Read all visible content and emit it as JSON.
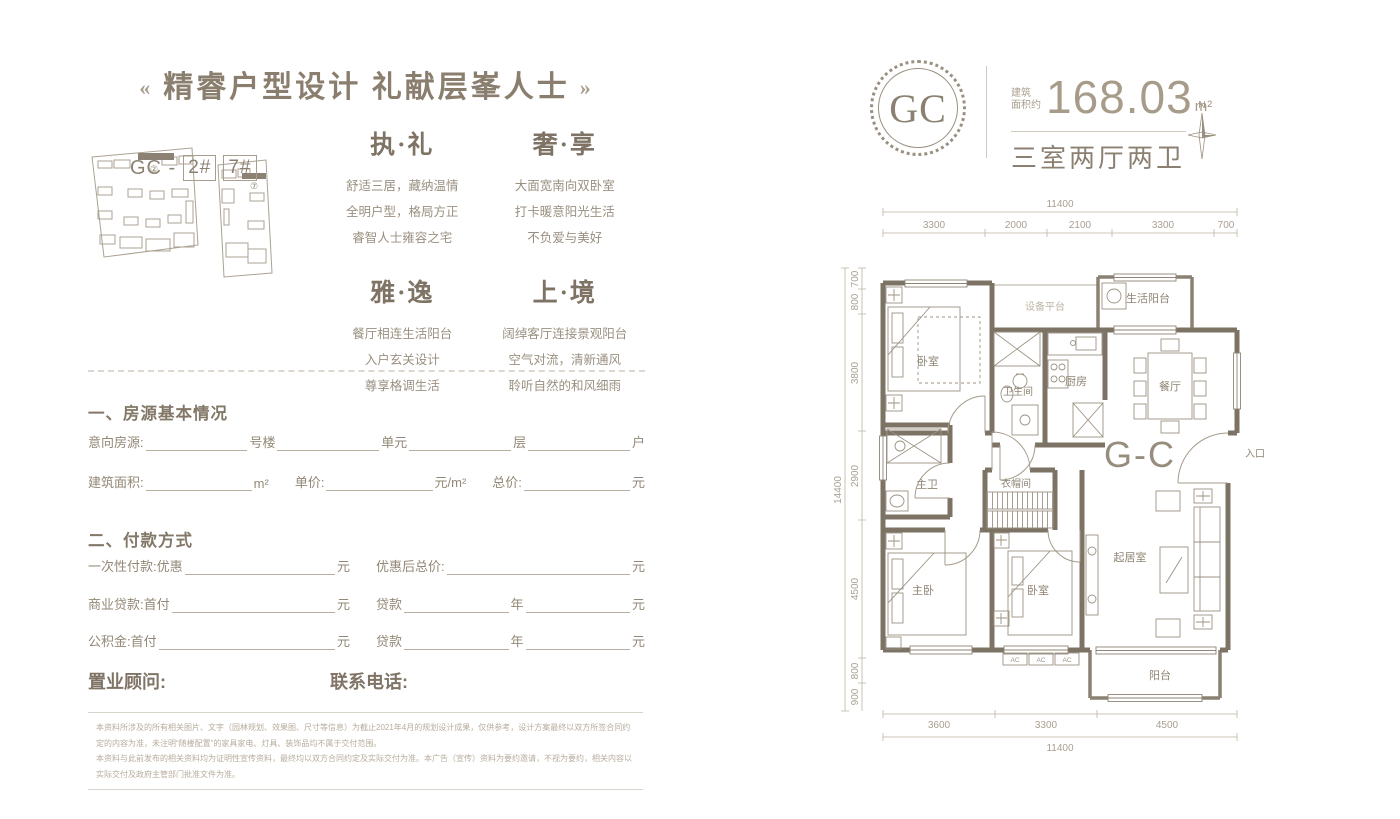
{
  "left": {
    "title": {
      "deco_left": "«",
      "text": "精睿户型设计 礼献层峯人士",
      "deco_right": "»"
    },
    "siteplan": {
      "plan1_tag": "②",
      "plan2_tag": "⑦",
      "caption_prefix": "GC -",
      "unit1": "2#",
      "unit2": "7#"
    },
    "features": [
      {
        "title": "执·礼",
        "lines": [
          "舒适三居，藏纳温情",
          "全明户型，格局方正",
          "睿智人士雍容之宅"
        ]
      },
      {
        "title": "奢·享",
        "lines": [
          "大面宽南向双卧室",
          "打卡暖意阳光生活",
          "不负爱与美好"
        ]
      },
      {
        "title": "雅·逸",
        "lines": [
          "餐厅相连生活阳台",
          "入户玄关设计",
          "尊享格调生活"
        ]
      },
      {
        "title": "上·境",
        "lines": [
          "阔绰客厅连接景观阳台",
          "空气对流，清新通风",
          "聆听自然的和风细雨"
        ]
      }
    ],
    "basic_info": {
      "heading": "一、房源基本情况",
      "row1": {
        "label": "意向房源:",
        "f1": "号楼",
        "f2": "单元",
        "f3": "层",
        "f4": "户"
      },
      "row2": {
        "label": "建筑面积:",
        "u1": "m²",
        "label2": "单价:",
        "u2": "元/m²",
        "label3": "总价:",
        "u3": "元"
      }
    },
    "payment": {
      "heading": "二、付款方式",
      "row1": {
        "l": "一次性付款:优惠",
        "lu": "元",
        "r": "优惠后总价:",
        "ru": "元"
      },
      "row2": {
        "l": "商业贷款:首付",
        "lu": "元",
        "r": "贷款",
        "rm": "年",
        "ru": "元"
      },
      "row3": {
        "l": "公积金:首付",
        "lu": "元",
        "r": "贷款",
        "rm": "年",
        "ru": "元"
      }
    },
    "consultant_label": "置业顾问:",
    "phone_label": "联系电话:",
    "disclaimer": [
      "本资料所涉及的所有相关图片、文字（园林规划、效果图、尺寸等信息）为截止2021年4月的规划设计成果，仅供参考，设计方案最终以双方所签合同约定的内容为准，未注明“随楼配置”的家具家电、灯具、装饰品均不属于交付范围。",
      "本资料与此前发布的相关资料均为证明性宣传资料，最终均以双方合同约定及实际交付为准。本广告（宣传）资料为要约邀请，不视为要约，相关内容以实际交付及政府主管部门批准文件为准。"
    ]
  },
  "right": {
    "badge": "GC",
    "area_label_1": "建筑",
    "area_label_2": "面积约",
    "area_value": "168.03",
    "area_unit": "m²",
    "layout_text": "三室两厅两卫",
    "compass_n": "N",
    "plan": {
      "unit_code": "G-C",
      "entrance": "入口",
      "ac": "AC",
      "rooms": {
        "bedroom_top": "卧室",
        "equipment": "设备平台",
        "life_balcony": "生活阳台",
        "bathroom": "卫生间",
        "kitchen": "厨房",
        "dining": "餐厅",
        "master_bath": "主卫",
        "closet": "衣帽间",
        "living": "起居室",
        "master_bedroom": "主卧",
        "bedroom_bottom": "卧室",
        "balcony": "阳台"
      },
      "dims_top": {
        "total": "11400",
        "segments": [
          "3300",
          "2000",
          "2100",
          "3300",
          "700"
        ]
      },
      "dims_left": {
        "total": "14400",
        "segments": [
          "700",
          "800",
          "3800",
          "2900",
          "4500",
          "800",
          "900"
        ]
      },
      "dims_bottom": {
        "total": "11400",
        "segments": [
          "3600",
          "3300",
          "4500"
        ]
      }
    }
  }
}
